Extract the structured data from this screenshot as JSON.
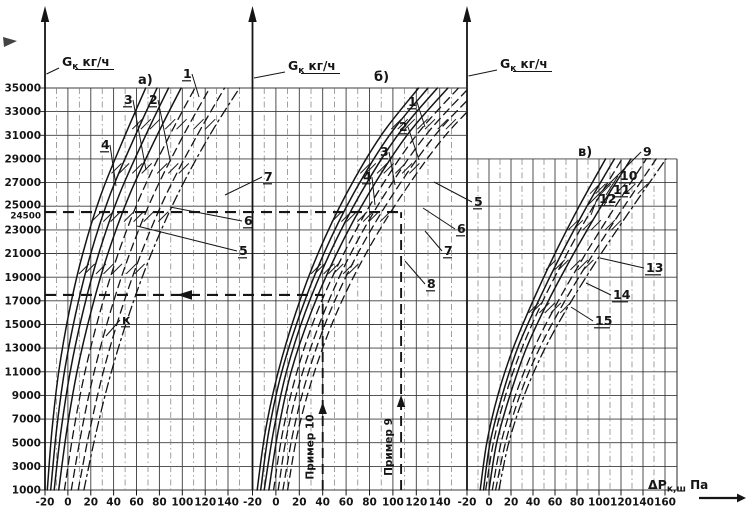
{
  "figure": {
    "kind": "scanned three-panel flow nomogram",
    "background": "#ffffff",
    "ink": "#151515"
  },
  "axis_titles": {
    "g": {
      "text": "Gк кг/ч",
      "main": "G",
      "sub": "к",
      "rest": " кг/ч"
    },
    "dp": {
      "text": "ΔPк,ш Па",
      "main": "ΔP",
      "sub": "к,ш",
      "rest": " Па"
    }
  },
  "y_ticks": [
    "35000",
    "33000",
    "31000",
    "29000",
    "27000",
    "25000",
    "24500",
    "23000",
    "21000",
    "19000",
    "17000",
    "15000",
    "13000",
    "11000",
    "9000",
    "7000",
    "5000",
    "3000",
    "1000"
  ],
  "panel_letters": [
    {
      "text": "а)",
      "x": 138,
      "y": 84
    },
    {
      "text": "б)",
      "x": 374,
      "y": 81
    },
    {
      "text": "в)",
      "x": 578,
      "y": 156
    }
  ],
  "chart_data": {
    "type": "line",
    "xlabel": "ΔPк,ш Па",
    "ylabel": "Gк кг/ч",
    "ylim": [
      1000,
      35000
    ],
    "grid": true,
    "legend": "none",
    "special_y_tick": "24500",
    "panels": [
      {
        "name": "а",
        "xticks": [
          -20,
          0,
          20,
          40,
          60,
          80,
          100,
          120,
          140
        ],
        "g_values": [
          1000,
          6000,
          11000,
          16000,
          21000,
          26000,
          31000,
          35000
        ],
        "series": [
          {
            "name": "1",
            "style": "solid",
            "dp": [
              -18,
              -14,
              -8,
              1,
              13,
              29,
              50,
              68
            ]
          },
          {
            "name": "2",
            "style": "solid",
            "dp": [
              -15,
              -10,
              -3,
              7,
              20,
              37,
              59,
              78
            ]
          },
          {
            "name": "3",
            "style": "solid",
            "dp": [
              -12,
              -6,
              2,
              13,
              27,
              45,
              68,
              88
            ]
          },
          {
            "name": "4",
            "style": "solid",
            "dp": [
              -8,
              -1,
              8,
              20,
              35,
              54,
              78,
              99
            ]
          },
          {
            "name": "5",
            "style": "dashed",
            "dp": [
              -3,
              5,
              15,
              28,
              44,
              64,
              89,
              111
            ]
          },
          {
            "name": "6",
            "style": "dashed",
            "dp": [
              3,
              12,
              23,
              37,
              54,
              75,
              101,
              124
            ]
          },
          {
            "name": "7",
            "style": "dashed",
            "dp": [
              9,
              19,
              31,
              46,
              64,
              86,
              113,
              137
            ]
          },
          {
            "name": "к",
            "style": "dashdot",
            "dp": [
              14,
              25,
              38,
              54,
              73,
              96,
              124,
              150
            ]
          }
        ],
        "labels": [
          {
            "t": "1",
            "x": 183,
            "y": 78,
            "lx": 199,
            "ly": 97
          },
          {
            "t": "2",
            "x": 149,
            "y": 104,
            "lx": 170,
            "ly": 160
          },
          {
            "t": "3",
            "x": 124,
            "y": 104,
            "lx": 146,
            "ly": 170
          },
          {
            "t": "4",
            "x": 101,
            "y": 149,
            "lx": 116,
            "ly": 186
          },
          {
            "t": "7",
            "x": 264,
            "y": 181,
            "lx": 225,
            "ly": 195
          },
          {
            "t": "6",
            "x": 244,
            "y": 225,
            "lx": 170,
            "ly": 207
          },
          {
            "t": "5",
            "x": 239,
            "y": 255,
            "lx": 137,
            "ly": 226
          },
          {
            "t": "к",
            "x": 122,
            "y": 324,
            "lx": 106,
            "ly": 336
          }
        ]
      },
      {
        "name": "б",
        "xticks": [
          -20,
          0,
          20,
          40,
          60,
          80,
          100,
          120,
          140
        ],
        "g_values": [
          1000,
          6000,
          11000,
          16000,
          21000,
          26000,
          31000,
          35000
        ],
        "series": [
          {
            "name": "1",
            "style": "solid",
            "dp": [
              -16,
              -9,
              2,
              17,
              36,
              60,
              90,
              122
            ]
          },
          {
            "name": "2",
            "style": "solid",
            "dp": [
              -13,
              -6,
              5,
              21,
              41,
              66,
              97,
              130
            ]
          },
          {
            "name": "3",
            "style": "solid",
            "dp": [
              -10,
              -2,
              9,
              25,
              46,
              72,
              104,
              138
            ]
          },
          {
            "name": "4",
            "style": "solid",
            "dp": [
              -6,
              2,
              13,
              30,
              52,
              79,
              112,
              147
            ]
          },
          {
            "name": "5",
            "style": "dashed",
            "dp": [
              -2,
              6,
              18,
              35,
              58,
              86,
              120,
              156
            ]
          },
          {
            "name": "6",
            "style": "dashed",
            "dp": [
              2,
              10,
              23,
              41,
              64,
              93,
              128,
              165
            ]
          },
          {
            "name": "7",
            "style": "dashed",
            "dp": [
              6,
              15,
              28,
              46,
              70,
              100,
              136,
              174
            ]
          },
          {
            "name": "8",
            "style": "dashed",
            "dp": [
              10,
              19,
              33,
              52,
              77,
              108,
              145,
              184
            ]
          }
        ],
        "labels": [
          {
            "t": "1",
            "x": 408,
            "y": 106,
            "lx": 425,
            "ly": 127
          },
          {
            "t": "2",
            "x": 399,
            "y": 131,
            "lx": 419,
            "ly": 160
          },
          {
            "t": "3",
            "x": 380,
            "y": 156,
            "lx": 395,
            "ly": 185
          },
          {
            "t": "4",
            "x": 363,
            "y": 181,
            "lx": 375,
            "ly": 205
          },
          {
            "t": "5",
            "x": 474,
            "y": 206,
            "lx": 434,
            "ly": 182
          },
          {
            "t": "6",
            "x": 457,
            "y": 233,
            "lx": 423,
            "ly": 208
          },
          {
            "t": "7",
            "x": 444,
            "y": 255,
            "lx": 425,
            "ly": 231
          },
          {
            "t": "8",
            "x": 427,
            "y": 288,
            "lx": 405,
            "ly": 261
          }
        ]
      },
      {
        "name": "в",
        "xticks": [
          -20,
          0,
          20,
          40,
          60,
          80,
          100,
          120,
          140,
          160
        ],
        "g_values": [
          1000,
          5000,
          9000,
          13000,
          17000,
          21000,
          25000,
          29000
        ],
        "series": [
          {
            "name": "9",
            "style": "solid",
            "dp": [
              -8,
              -2,
              8,
              22,
              40,
              60,
              82,
              106
            ]
          },
          {
            "name": "10",
            "style": "solid",
            "dp": [
              -5,
              1,
              12,
              26,
              45,
              66,
              89,
              114
            ]
          },
          {
            "name": "11",
            "style": "dashed",
            "dp": [
              -3,
              4,
              15,
              30,
              49,
              71,
              95,
              121
            ]
          },
          {
            "name": "12",
            "style": "solid",
            "dp": [
              0,
              7,
              19,
              34,
              54,
              77,
              102,
              129
            ]
          },
          {
            "name": "13",
            "style": "dashed",
            "dp": [
              3,
              11,
              24,
              41,
              63,
              88,
              115,
              143
            ]
          },
          {
            "name": "14",
            "style": "dashed",
            "dp": [
              6,
              15,
              28,
              46,
              69,
              95,
              123,
              152
            ]
          },
          {
            "name": "15",
            "style": "dashdot",
            "dp": [
              9,
              18,
              32,
              51,
              75,
              102,
              131,
              161
            ]
          }
        ],
        "labels": [
          {
            "t": "9",
            "x": 643,
            "y": 156,
            "lx": 588,
            "ly": 205
          },
          {
            "t": "10",
            "x": 620,
            "y": 180,
            "lx": 606,
            "ly": 195
          },
          {
            "t": "11",
            "x": 613,
            "y": 194,
            "lx": 604,
            "ly": 206
          },
          {
            "t": "12",
            "x": 599,
            "y": 203,
            "lx": 591,
            "ly": 215
          },
          {
            "t": "13",
            "x": 646,
            "y": 272,
            "lx": 600,
            "ly": 258
          },
          {
            "t": "14",
            "x": 613,
            "y": 299,
            "lx": 586,
            "ly": 283
          },
          {
            "t": "15",
            "x": 595,
            "y": 325,
            "lx": 571,
            "ly": 307
          }
        ]
      }
    ],
    "reference_lines": [
      {
        "kind": "example",
        "label": "Пример 10",
        "panel": "б",
        "dp": 40,
        "g": 17500
      },
      {
        "kind": "example",
        "label": "Пример 9",
        "panel": "б",
        "dp": 107,
        "g": 24500
      }
    ]
  }
}
